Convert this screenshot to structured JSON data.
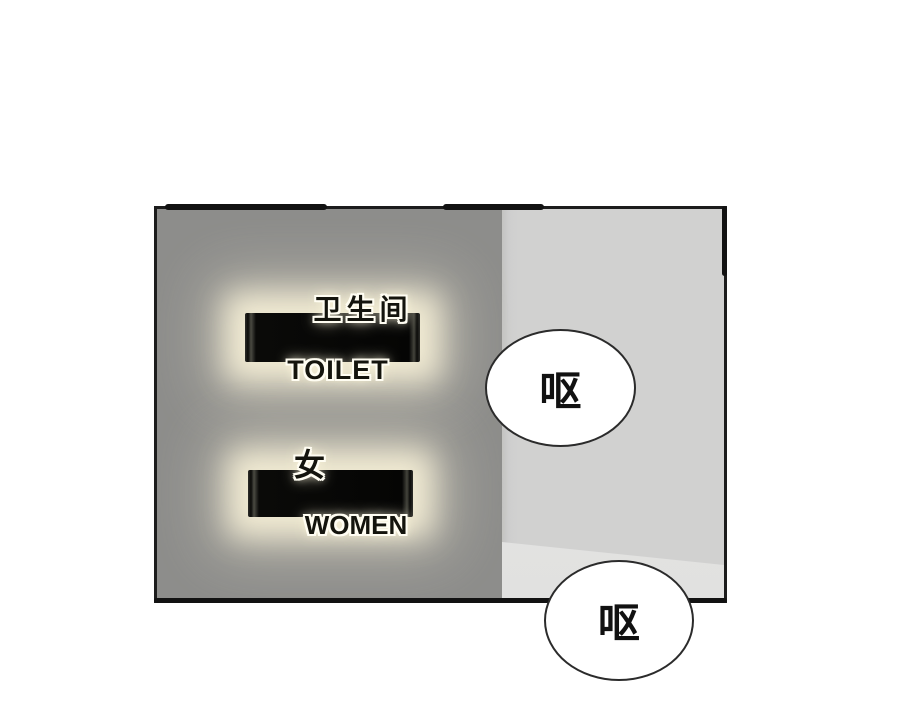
{
  "panel": {
    "description": "Comic panel showing a backlit restroom wall sign at a corner of two walls",
    "signs": [
      {
        "top_label": "卫生间",
        "bottom_label": "TOILET"
      },
      {
        "top_label": "女",
        "bottom_label": "WOMEN"
      }
    ],
    "colors": {
      "wall_left": "#8d8d8b",
      "wall_right": "#d1d1d0",
      "wall_floor_sheen": "#e4e4e3",
      "sign_bar": "#0a0a08",
      "backlight_glow": "#f6f0d7",
      "panel_border": "#1c1c1c",
      "background": "#ffffff"
    }
  },
  "speech_bubbles": [
    {
      "text": "呕"
    },
    {
      "text": "呕"
    }
  ]
}
